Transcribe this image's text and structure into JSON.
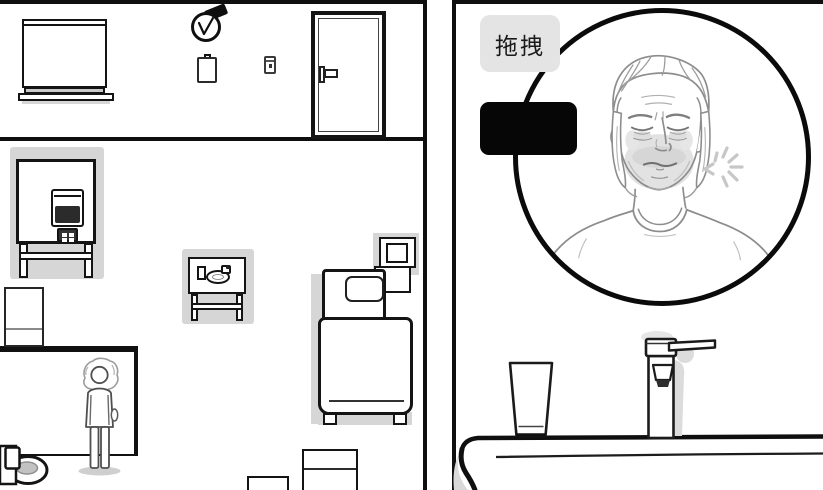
{
  "ui": {
    "drag_label": "拖拽"
  },
  "colors": {
    "outline": "#141414",
    "sketch_line": "#8d8d8d",
    "shadow_gray": "#d6d6d6",
    "label_background": "#e4e4e4",
    "black_box": "#060606",
    "tv_screen": "#2b2b2b",
    "background": "#ffffff"
  },
  "left_panel": {
    "objects": [
      "window-blinds",
      "alarm-clock",
      "notepad",
      "light-switch",
      "door",
      "tv-set-on-table",
      "side-table-with-dishes",
      "bed-with-pillow",
      "nightstand",
      "kitchen-counter",
      "white-cabinet",
      "standing-person",
      "toilet",
      "small-box",
      "large-box"
    ]
  },
  "right_panel": {
    "objects": [
      "drag-label",
      "redacted-black-box",
      "sleeping-man-portrait",
      "annoyance-spark",
      "drinking-glass",
      "faucet",
      "sink-counter"
    ]
  }
}
